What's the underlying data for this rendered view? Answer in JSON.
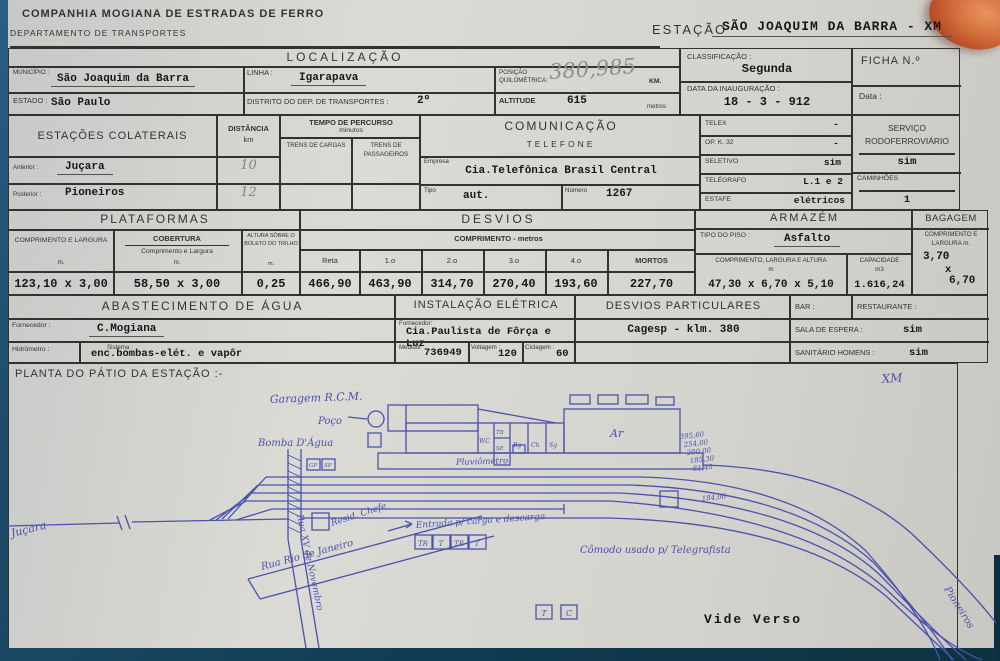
{
  "colors": {
    "paper": "#d7d6d1",
    "print_ink": "#35332f",
    "typed_ink": "#17161a",
    "blueprint_ink": "#4a51ae",
    "pencil": "#84847a",
    "backdrop": "#113c52",
    "finger": "#c05a32"
  },
  "header": {
    "company": "COMPANHIA MOGIANA DE ESTRADAS DE FERRO",
    "department": "DEPARTAMENTO DE TRANSPORTES",
    "station_label": "ESTAÇÃO",
    "station_value": "SÃO JOAQUIM DA BARRA - XM"
  },
  "localizacao": {
    "title": "LOCALIZAÇÃO",
    "municipio_label": "MUNICÍPIO :",
    "municipio": "São Joaquim da Barra",
    "linha_label": "LINHA :",
    "linha": "Igarapava",
    "estado_label": "ESTADO :",
    "estado": "São Paulo",
    "distrito_label": "DISTRITO DO DEP. DE TRANSPORTES :",
    "distrito": "2º",
    "posicao_label": "POSIÇÃO QUILOMÉTRICA:",
    "posicao": "380,985",
    "posicao_unit": "KM.",
    "altitude_label": "ALTITUDE",
    "altitude": "615",
    "altitude_unit": "metros"
  },
  "classificacao": {
    "label": "CLASSIFICAÇÃO :",
    "value": "Segunda",
    "inauguracao_label": "DATA DA INAUGURAÇÃO :",
    "inauguracao_value": "18 - 3 - 912"
  },
  "ficha": {
    "label": "FICHA N.º",
    "data_label": "Data :"
  },
  "colaterais": {
    "title": "ESTAÇÕES COLATERAIS",
    "distancia_label": "DISTÂNCIA",
    "distancia_unit": "km",
    "tempo_title": "TEMPO DE PERCURSO",
    "tempo_unit": "minutos",
    "col_cargas": "TRENS DE CARGAS",
    "col_passageiros": "TRENS DE PASSAGEIROS",
    "anterior_label": "Anterior :",
    "anterior": "Juçara",
    "anterior_dist": "10",
    "posterior_label": "Posterior :",
    "posterior": "Pioneiros",
    "posterior_dist": "12"
  },
  "comunicacao": {
    "title": "COMUNICAÇÃO",
    "subtitle": "TELEFONE",
    "empresa_label": "Empresa",
    "empresa": "Cia.Telefônica Brasil Central",
    "tipo_label": "Tipo",
    "tipo": "aut.",
    "numero_label": "Número",
    "numero": "1267"
  },
  "telex": {
    "telex_label": "TELEX",
    "telex": "-",
    "opk_label": "OP. K. 32",
    "opk": "-",
    "seletivo_label": "SELETIVO",
    "seletivo": "sim",
    "telegrafo_label": "TELÉGRAFO",
    "telegrafo": "L.1 e 2",
    "estafe_label": "ESTAFE",
    "estafe": "elétricos"
  },
  "rodo": {
    "title": "SERVIÇO RODOFERROVIÁRIO",
    "value": "sim",
    "caminhoes_label": "CAMINHÕES",
    "caminhoes": "1"
  },
  "plataformas": {
    "title": "PLATAFORMAS",
    "c1_label": "COMPRIMENTO E LARGURA",
    "c1_unit": "m.",
    "c1": "123,10 x 3,00",
    "c2_label": "COBERTURA",
    "c2_sub": "Comprimento e Largura",
    "c2_unit": "m.",
    "c2": "58,50 x 3,00",
    "c3_label": "ALTURA SÔBRE O BOLETO DO TRILHO",
    "c3_unit": "m.",
    "c3": "0,25"
  },
  "desvios": {
    "title": "DESVIOS",
    "subtitle": "COMPRIMENTO - metros",
    "columns": [
      "Reta",
      "1.o",
      "2.o",
      "3.o",
      "4.o",
      "MORTOS"
    ],
    "values": [
      "466,90",
      "463,90",
      "314,70",
      "270,40",
      "193,60",
      "227,70"
    ]
  },
  "armazem": {
    "title": "ARMAZÉM",
    "piso_label": "TIPO DO PISO :",
    "piso": "Asfalto",
    "dim_label": "COMPRIMENTO, LARGURA E ALTURA",
    "dim_unit": "m",
    "dim": "47,30 x 6,70 x 5,10",
    "cap_label": "CAPACIDADE",
    "cap_unit": "m3",
    "cap": "1.616,24"
  },
  "bagagem": {
    "title": "BAGAGEM",
    "dim_label": "COMPRIMENTO E LARGURA m.",
    "l1": "3,70",
    "x": "x",
    "l2": "6,70"
  },
  "agua": {
    "title": "ABASTECIMENTO DE ÁGUA",
    "fornecedor_label": "Fornecedor :",
    "fornecedor": "C.Mogiana",
    "hidrometro_label": "Hidrômetro :",
    "sistema_label": "Sistema :",
    "sistema": "enc.bombas-elét. e vapôr"
  },
  "eletrica": {
    "title": "INSTALAÇÃO ELÉTRICA",
    "fornecedor_label": "Fornecedor:",
    "fornecedor": "Cia.Paulista de Fôrça e Luz",
    "medidor_label": "Medidor",
    "medidor": "736949",
    "voltagem_label": "Voltagem :",
    "voltagem": "120",
    "ciclagem_label": "Ciclagem :",
    "ciclagem": "60"
  },
  "desvios_particulares": {
    "title": "DESVIOS PARTICULARES",
    "value": "Cagesp - klm. 380"
  },
  "servicos": {
    "bar_label": "BAR :",
    "restaurante_label": "RESTAURANTE :",
    "sala_label": "SALA DE ESPERA :",
    "sala": "sim",
    "sanitario_label": "SANITÁRIO HOMENS :",
    "sanitario": "sim"
  },
  "planta": {
    "title": "PLANTA DO PÁTIO DA ESTAÇÃO :-",
    "xm": "XM",
    "garagem": "Garagem R.C.M.",
    "poco": "Poço",
    "bomba": "Bomba D'Água",
    "pluviometro": "Pluviômetro",
    "ar": "Ar",
    "rooms": [
      "WC",
      "TB",
      "SE",
      "Bg",
      "Ch",
      "Sg"
    ],
    "gp": "GP",
    "sp": "SP",
    "resid": "Resid. Chefe",
    "entrada": "Entrada p/ carga e descarga",
    "tr_boxes": [
      "TR",
      "T",
      "TR",
      "T"
    ],
    "comodo": "Cômodo usado p/ Telegrafista",
    "rua_rio": "Rua Rio de Janeiro",
    "rua_xv": "Rua XV de Novembro",
    "track_numbers": [
      "395,60",
      "254,00",
      "200,00",
      "185,30",
      "81,40"
    ],
    "track_number_south": "184,00",
    "jucara": "Juçara",
    "pioneiros": "Pioneiros",
    "t_box": "T",
    "c_box": "C",
    "vide_verso": "Vide Verso"
  }
}
